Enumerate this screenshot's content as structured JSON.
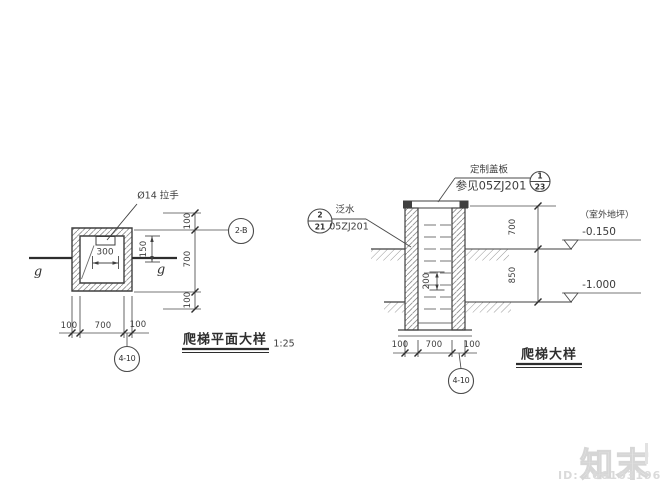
{
  "plan": {
    "title": "爬梯平面大样",
    "scale": "1:25",
    "handle_label": "Ø14 拉手",
    "dim_300": "300",
    "dim_150": "150",
    "right_dim_top": "100",
    "right_dim_mid": "700",
    "right_dim_bot": "100",
    "bottom_dim_left": "100",
    "bottom_dim_mid": "700",
    "bottom_dim_right": "100",
    "axis_left": "g",
    "axis_right": "g",
    "bubble_right": "2-B",
    "bubble_bottom": "4-10"
  },
  "section": {
    "title": "爬梯大样",
    "cover_line1": "定制盖板",
    "cover_line2": "参见05ZJ201",
    "cover_bubble_num": "1",
    "cover_bubble_sheet": "23",
    "flash_line1": "泛水",
    "flash_line2": "05ZJ201",
    "flash_bubble_num": "2",
    "flash_bubble_sheet": "21",
    "site_label": "（室外地坪）",
    "lvl_upper": "-0.150",
    "lvl_lower": "-1.000",
    "dim_700": "700",
    "dim_850": "850",
    "dim_200": "200",
    "bottom_dim_left": "100",
    "bottom_dim_mid": "700",
    "bottom_dim_right": "100",
    "bubble_bottom": "4-10"
  },
  "watermark": {
    "brand": "知末",
    "id": "ID: 166103196"
  }
}
